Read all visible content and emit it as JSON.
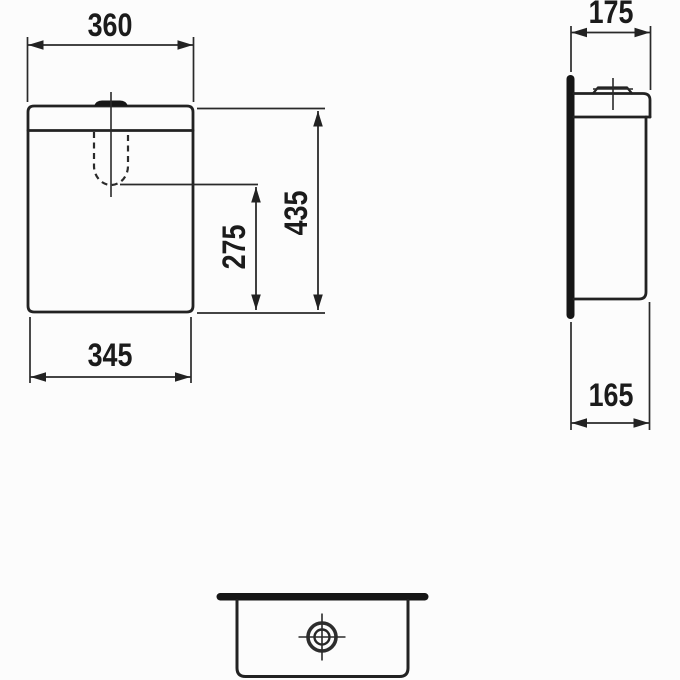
{
  "page": {
    "background_color": "#fcfcfc",
    "line_color": "#222222",
    "text_color": "#1b1b1b"
  },
  "drawing": {
    "kind": "technical-dimension-drawing",
    "subject": "toilet cistern / tank",
    "views": {
      "front": {
        "label": "front-view",
        "dimensions": {
          "top_width": "360",
          "overall_height": "435",
          "flush_valve_height": "275",
          "bottom_width": "345"
        }
      },
      "side": {
        "label": "side-view",
        "dimensions": {
          "top_depth": "175",
          "bottom_depth": "165"
        }
      },
      "plan": {
        "label": "plan-view",
        "symbols": [
          "inlet-target-symbol"
        ]
      }
    }
  }
}
